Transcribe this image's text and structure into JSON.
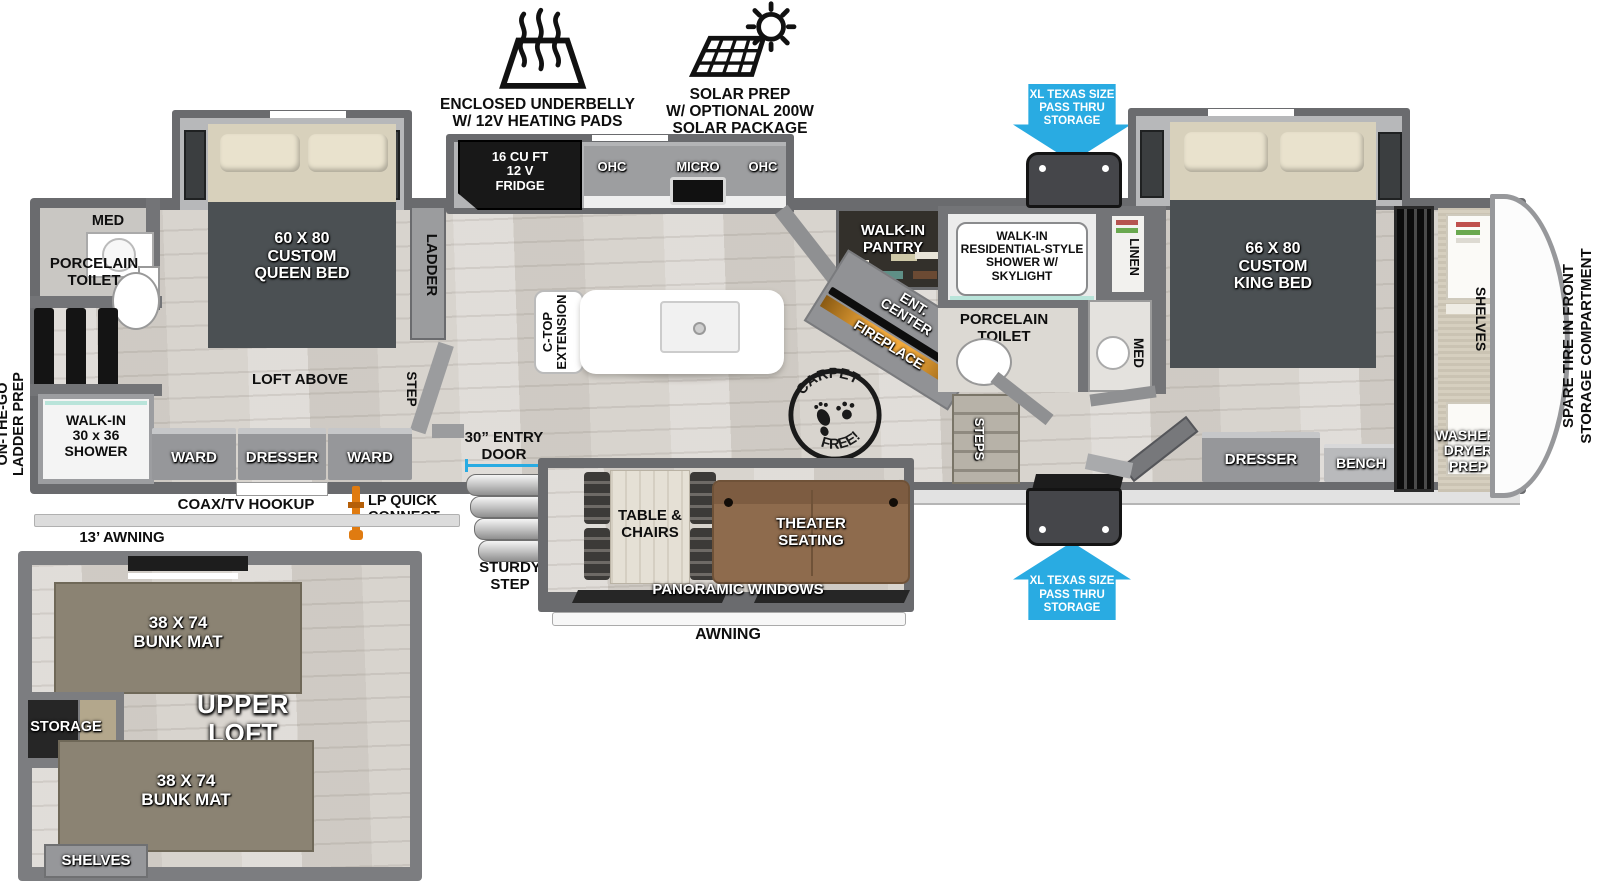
{
  "legend": {
    "underbelly_label": "ENCLOSED UNDERBELLY\nW/ 12V HEATING PADS",
    "solar_label": "SOLAR PREP\nW/ OPTIONAL 200W\nSOLAR PACKAGE"
  },
  "pass_thru": {
    "top_label": "XL TEXAS SIZE\nPASS THRU\nSTORAGE",
    "bottom_label": "XL TEXAS SIZE\nPASS THRU\nSTORAGE"
  },
  "rear_bath": {
    "med": "MED",
    "toilet": "PORCELAIN\nTOILET",
    "ladder_prep": "ON-THE-GO\nLADDER PREP",
    "shower": "WALK-IN\n30 x 36\nSHOWER"
  },
  "rear_bedroom": {
    "bed": "60 X  80\nCUSTOM\nQUEEN BED",
    "loft": "LOFT ABOVE",
    "ladder": "LADDER",
    "step": "STEP",
    "ward1": "WARD",
    "dresser": "DRESSER",
    "ward2": "WARD"
  },
  "kitchen": {
    "fridge": "16 CU FT\n12 V\nFRIDGE",
    "ohc_left": "OHC",
    "micro": "MICRO",
    "ohc_right": "OHC",
    "ctop": "C-TOP\nEXTENSION",
    "entry_door": "30” ENTRY\nDOOR",
    "sturdy_step": "STURDY\nSTEP"
  },
  "living": {
    "pantry": "WALK-IN\nPANTRY",
    "ent_center": "ENT.\nCENTER",
    "fireplace": "FIREPLACE",
    "table": "TABLE &\nCHAIRS",
    "theater": "THEATER\nSEATING",
    "windows": "PANORAMIC WINDOWS",
    "awning": "AWNING",
    "stamp_word1": "CARPET",
    "stamp_word2": "FREE!"
  },
  "mid_bath": {
    "shower": "WALK-IN\nRESIDENTIAL-STYLE\nSHOWER W/\nSKYLIGHT",
    "linen": "LINEN",
    "toilet": "PORCELAIN\nTOILET",
    "med": "MED",
    "steps": "STEPS"
  },
  "front_bedroom": {
    "bed": "66 X  80\nCUSTOM\nKING BED",
    "dresser": "DRESSER",
    "bench": "BENCH",
    "shelves": "SHELVES",
    "washer": "WASHER/\nDRYER\nPREP",
    "spare_tire": "SPARE TIRE IN FRONT\nSTORAGE COMPARTMENT"
  },
  "exterior": {
    "coax": "COAX/TV HOOKUP",
    "lp": "LP QUICK\nCONNECT",
    "awning13": "13’ AWNING"
  },
  "loft": {
    "bunk1": "38 X 74\nBUNK MAT",
    "bunk2": "38 X 74\nBUNK MAT",
    "storage": "STORAGE",
    "title": "UPPER\nLOFT",
    "shelves": "SHELVES"
  },
  "colors": {
    "arrow_blue": "#29abe2",
    "wall_grey": "#6a6b6e",
    "bed_grey": "#4b5053",
    "sofa_brown": "#8e6b4d",
    "bunk_tan": "#8b8373",
    "fireplace_amber": "#f2a93b",
    "lp_orange": "#e07b10"
  }
}
